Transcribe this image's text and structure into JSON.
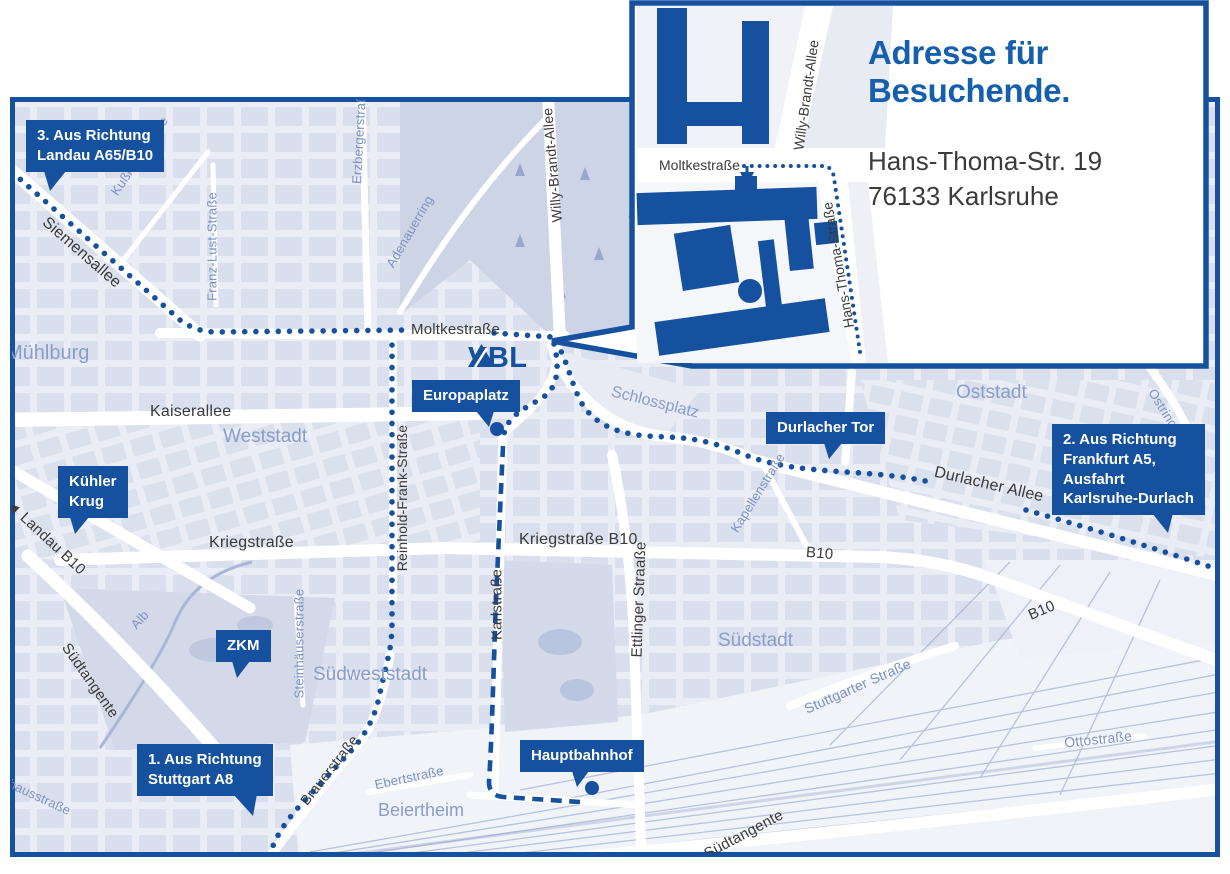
{
  "colors": {
    "brand_blue": "#15519E",
    "heading_blue": "#155FAC",
    "text_dark": "#3B3B3A",
    "street_label_dark": "#3A3A3A",
    "street_label_blue": "#7E91C0",
    "area_label_blue": "#8A9CC9",
    "map_blocks": "#D9DFEC",
    "map_streets": "#FFFFFF"
  },
  "inset": {
    "title_line1": "Adresse für",
    "title_line2": "Besuchende.",
    "address_line1": "Hans-Thoma-Str. 19",
    "address_line2": "76133 Karlsruhe",
    "street_moltkestrasse": "Moltkestraße",
    "street_willy_brandt_allee": "Willy-Brandt-Allee",
    "street_hans_thoma_strasse": "Hans-Thoma-Straße"
  },
  "logo": {
    "name": "VBL"
  },
  "callouts": {
    "landau": {
      "line1": "3. Aus Richtung",
      "line2": "Landau A65/B10"
    },
    "frankfurt": {
      "line1": "2. Aus Richtung",
      "line2": "Frankfurt A5,",
      "line3": "Ausfahrt",
      "line4": "Karlsruhe-Durlach"
    },
    "stuttgart": {
      "line1": "1. Aus Richtung",
      "line2": "Stuttgart A8"
    },
    "kuehler_krug": {
      "line1": "Kühler",
      "line2": "Krug"
    },
    "zkm": {
      "label": "ZKM"
    },
    "europaplatz": {
      "label": "Europaplatz"
    },
    "durlacher_tor": {
      "label": "Durlacher Tor"
    },
    "hauptbahnhof": {
      "label": "Hauptbahnhof"
    }
  },
  "streets": {
    "siemensallee": "Siemensallee",
    "moltkestrasse": "Moltkestraße",
    "kaiserallee": "Kaiserallee",
    "kriegstrasse": "Kriegstraße",
    "kriegstrasse_b10": "Kriegstraße B10",
    "b10_a": "B10",
    "b10_b": "B10",
    "karlstrasse": "Karlstraße",
    "ettlinger_strasse": "Ettlinger Straaße",
    "durlacher_allee": "Durlacher Allee",
    "willy_brandt_allee": "Willy-Brandt-Allee",
    "reinhold_frank_strasse": "Reinhold-Frank-Straße",
    "suedtangente_a": "Südtangente",
    "suedtangente_b": "Südtangente",
    "brauerstrasse": "Brauerstraße",
    "landau_b10": "Landau B10",
    "kussmaulstrasse": "Kußmaulstraße",
    "franz_lust_strasse": "Franz-Lust-Straße",
    "erzbergerstrasse": "Erzbergerstraße",
    "adenauerring": "Adenauerring",
    "kapellenstrasse": "Kapellenstraße",
    "steinhaeuserstrasse": "Steinhäuserstraße",
    "stuttgarter_strasse": "Stuttgarter Straße",
    "ebertstrasse": "Ebertstraße",
    "ottostrasse": "Ottostraße",
    "ostring": "Ostring",
    "alb": "Alb",
    "pulverhausstrasse": "Pulverhausstraße"
  },
  "areas": {
    "muehlburg": "Mühlburg",
    "weststadt": "Weststadt",
    "oststadt": "Oststadt",
    "suedstadt": "Südstadt",
    "suedweststadt": "Südweststadt",
    "beiertheim": "Beiertheim",
    "schlossplatz": "Schlossplatz"
  },
  "icons": {
    "landau_direction_arrow": "◄"
  }
}
